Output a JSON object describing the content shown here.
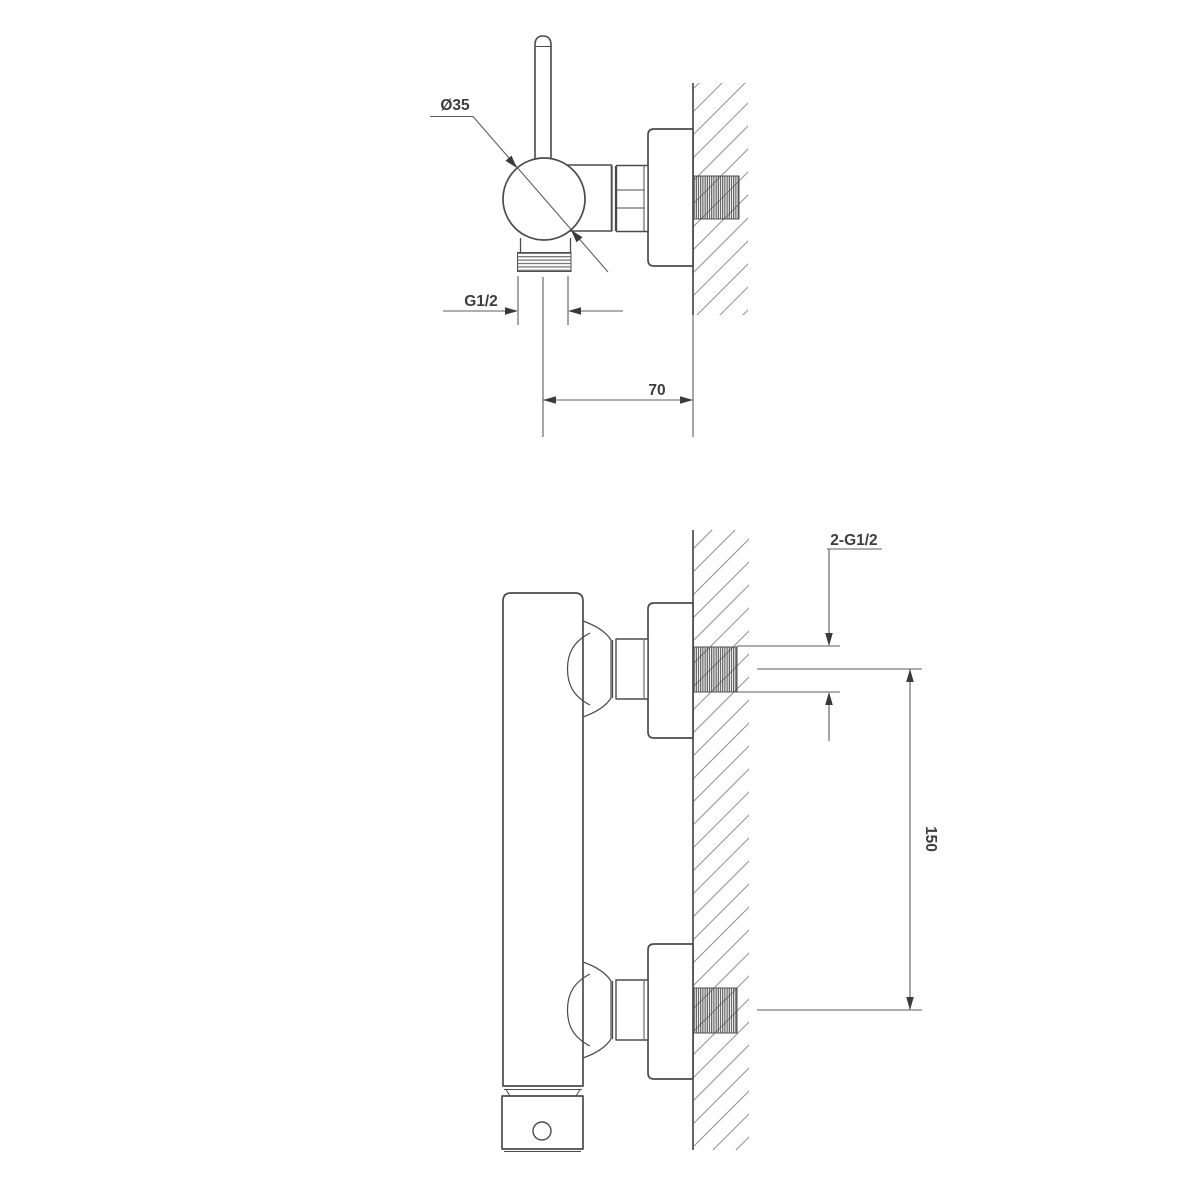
{
  "page": {
    "background": "#ffffff",
    "description_colors": {
      "part_outline": "#4b4b4b",
      "dimension_line": "#5c5c5c",
      "arrowhead": "#3a3a3a",
      "wall_hatch": "#909090",
      "thread_fill": "#4f4f4f",
      "label_text": "#3d3d3d"
    }
  },
  "top_view": {
    "labels": {
      "knob_diameter": "Ø35",
      "outlet_thread": "G1/2",
      "wall_distance": "70"
    }
  },
  "front_view": {
    "labels": {
      "inlet_threads": "2-G1/2",
      "inlet_spacing": "150"
    }
  }
}
